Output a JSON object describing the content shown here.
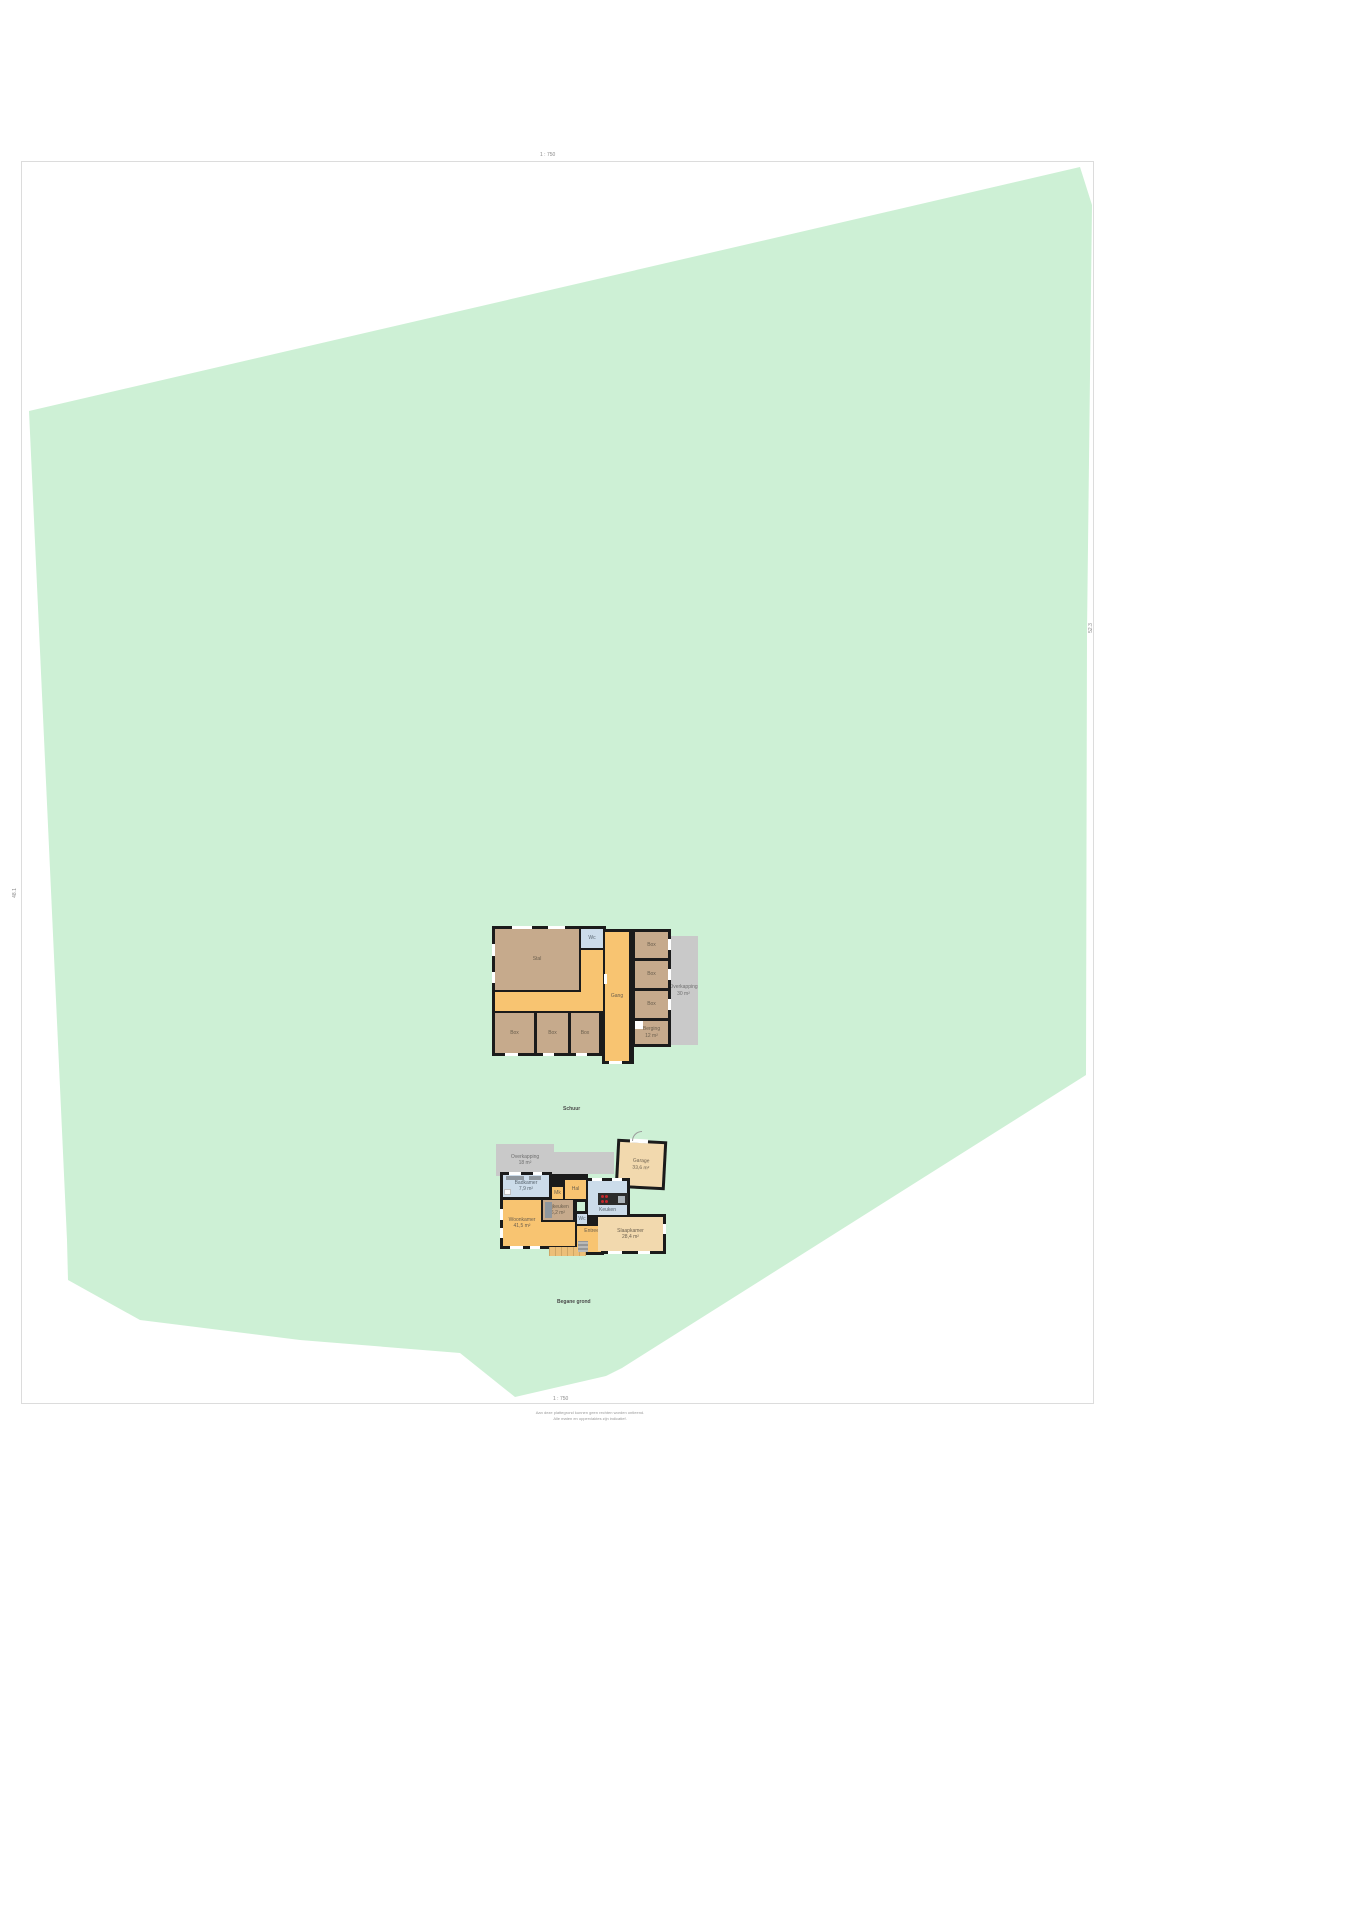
{
  "meta": {
    "scale_top": "1 : 750",
    "scale_bottom": "1 : 750",
    "marker_left": "48.1",
    "marker_right": "52.3",
    "caption_upper": "Schuur",
    "caption_lower": "Begane grond",
    "disclaimer1": "Aan deze plattegrond kunnen geen rechten worden ontleend.",
    "disclaimer2": "Alle maten en oppervlaktes zijn indicatief."
  },
  "colors": {
    "plot": "#cdf0d5",
    "wall": "#1b1b1b",
    "room_brown": "#c6aa8c",
    "hall_orange": "#f8c471",
    "room_peach": "#f2d9ae",
    "room_blue": "#ccdcea",
    "area_gray": "#c9c9c9"
  },
  "upper": {
    "rooms": {
      "stal": "Stal",
      "wc": "Wc",
      "gang": "Gang",
      "box1": "Box",
      "box2": "Box",
      "box3": "Box",
      "box4": "Box",
      "box5": "Box",
      "box6": "Box",
      "berging_l1": "Berging",
      "berging_l2": "12 m²",
      "overkapping_l1": "Overkapping",
      "overkapping_l2": "30 m²"
    }
  },
  "lower": {
    "rooms": {
      "overkapping_l1": "Overkapping",
      "overkapping_l2": "18 m²",
      "badkamer_l1": "Badkamer",
      "badkamer_l2": "7,9 m²",
      "hal": "Hal",
      "mk": "Mk",
      "keuken": "Keuken",
      "bijkeuken_l1": "Bijkeuken",
      "bijkeuken_l2": "6,2 m²",
      "woonkamer_l1": "Woonkamer",
      "woonkamer_l2": "41,5 m²",
      "wc": "Wc",
      "entree": "Entree",
      "garage_l1": "Garage",
      "garage_l2": "33,6 m²",
      "slaapkamer_l1": "Slaapkamer",
      "slaapkamer_l2": "28,4 m²"
    }
  }
}
